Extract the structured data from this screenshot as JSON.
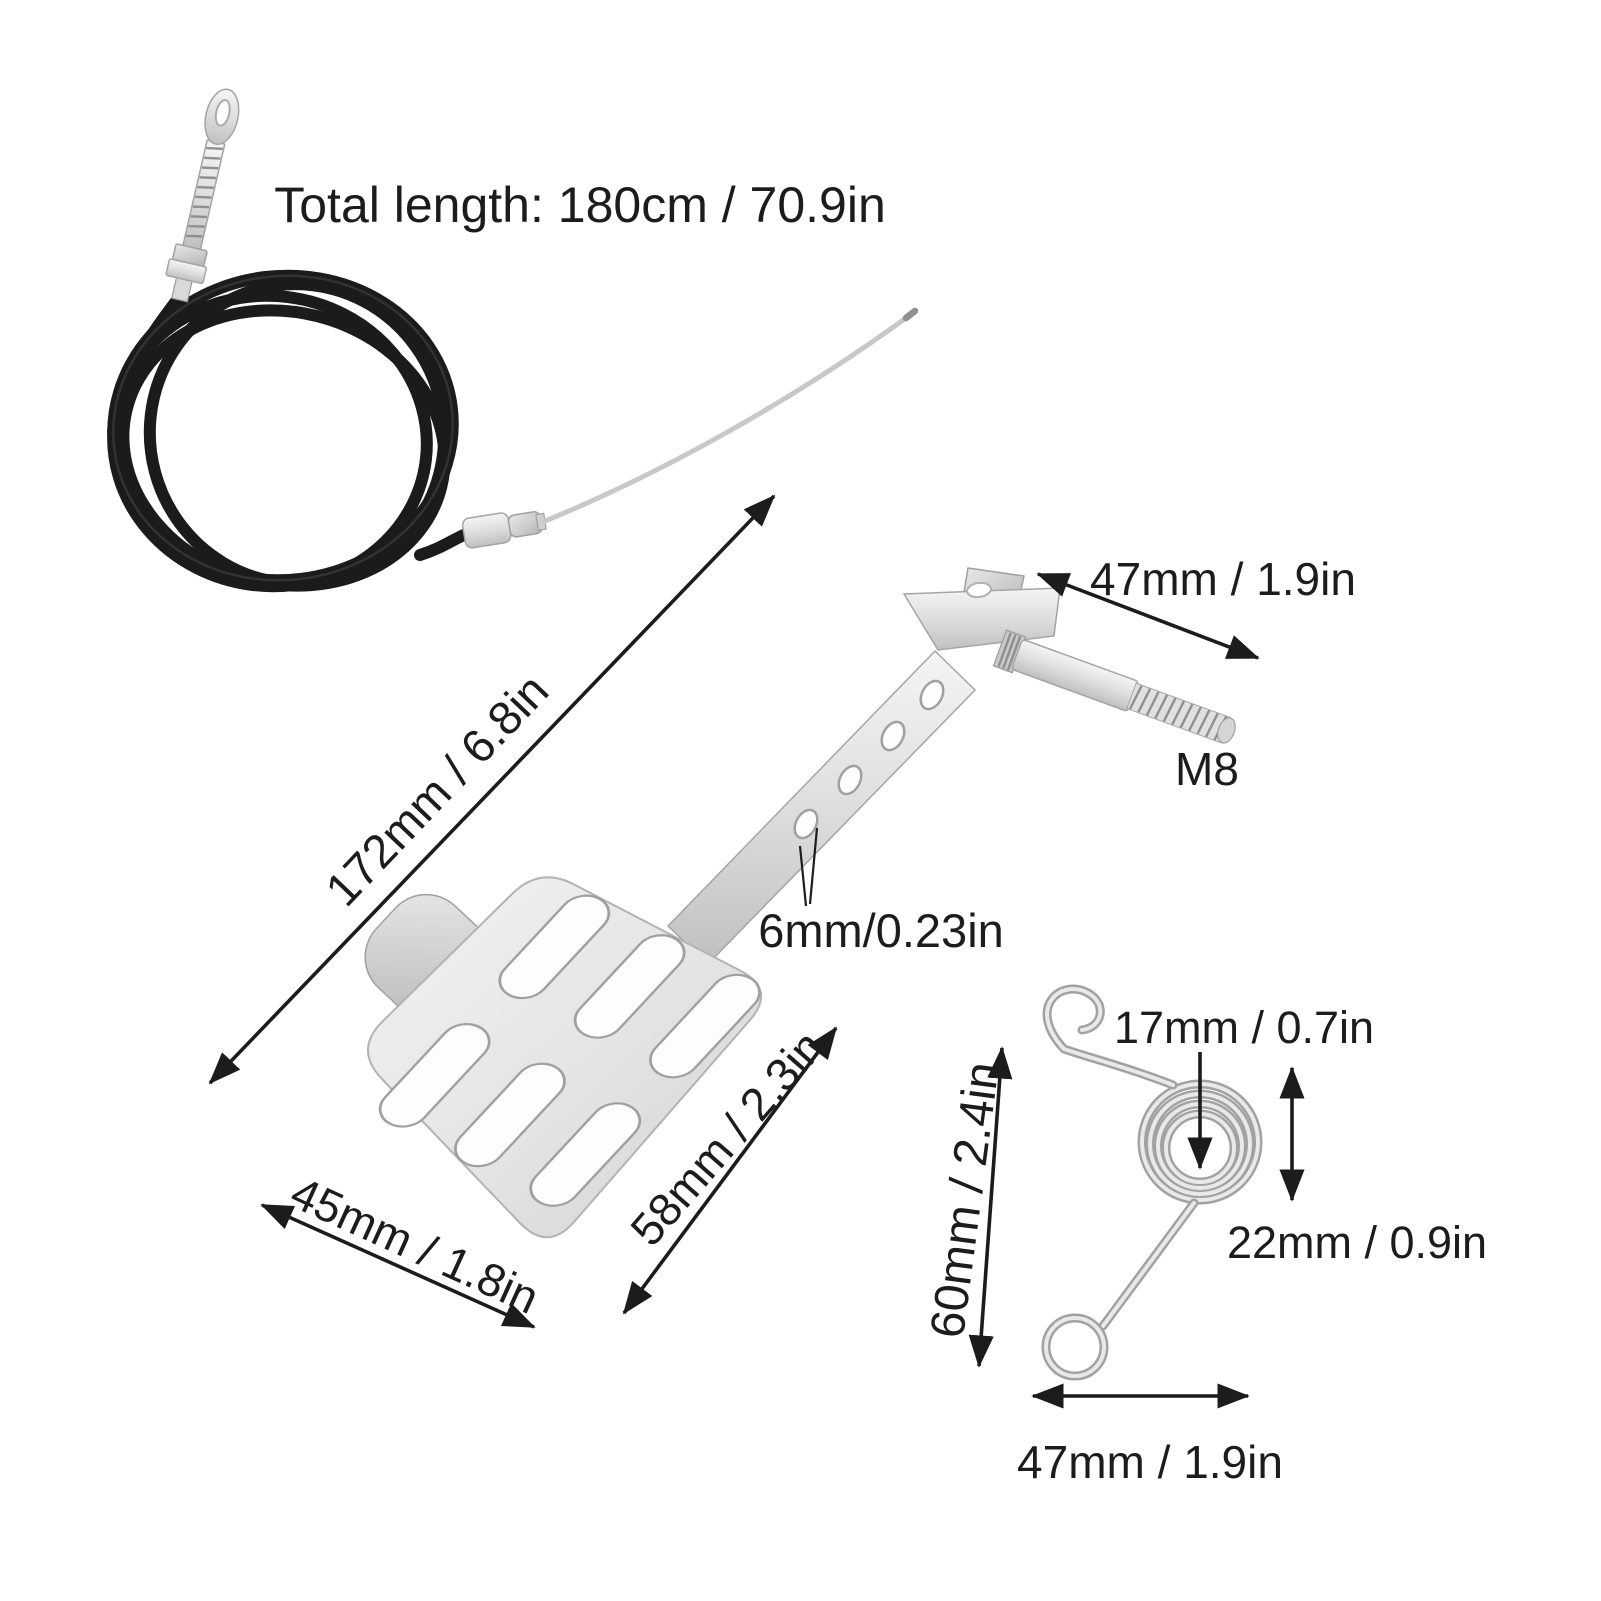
{
  "title": "Total length: 180cm / 70.9in",
  "dimensions": {
    "bolt_length": "47mm / 1.9in",
    "thread_size": "M8",
    "lever_length": "172mm / 6.8in",
    "hole_diameter": "6mm/0.23in",
    "pedal_width": "45mm / 1.8in",
    "pedal_depth": "58mm / 2.3in",
    "spring_inner_diameter": "17mm / 0.7in",
    "spring_coil_height": "22mm / 0.9in",
    "spring_height": "60mm / 2.4in",
    "spring_width": "47mm / 1.9in"
  },
  "colors": {
    "background": "#ffffff",
    "annotation": "#1c1c1c",
    "cable_sheath": "#1b1b1b",
    "metal_light": "#f2f2f2",
    "metal_mid": "#d8d8d8",
    "metal_dark": "#bdbdbd"
  }
}
